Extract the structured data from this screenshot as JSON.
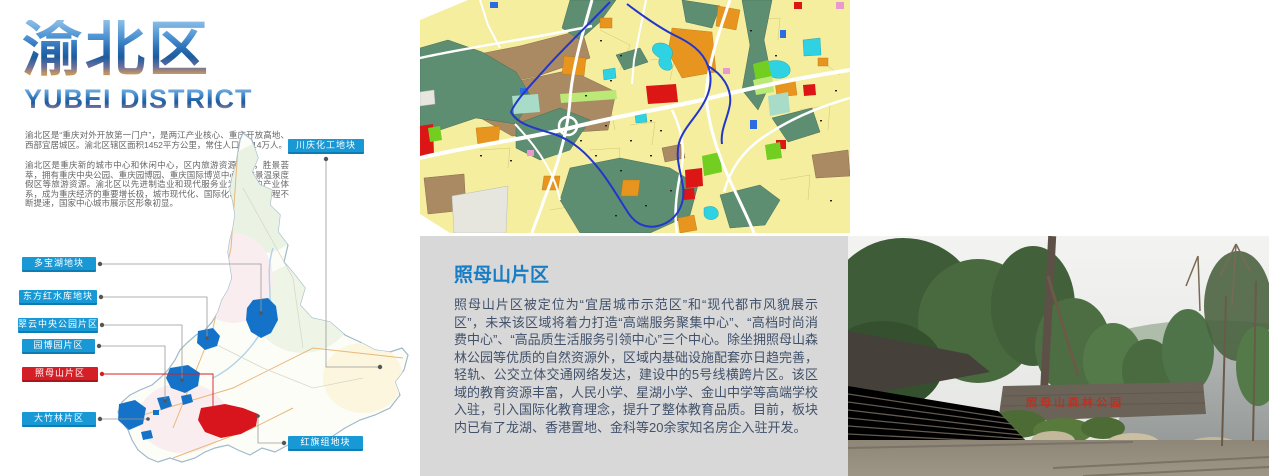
{
  "left": {
    "title_cn": "渝北区",
    "title_en": "YUBEI DISTRICT",
    "para1": "渝北区是“重庆对外开放第一门户”，是两江产业核心、重庆开放高地、西部宜居城区。渝北区辖区面积1452平方公里，常住人口约114万人。",
    "para2": "渝北区是重庆新的城市中心和休闲中心，区内旅游资源丰富，胜景荟萃，拥有重庆中央公园、重庆园博园、重庆国际博览中心、统景温泉度假区等旅游资源。渝北区以先进制造业和现代服务业为核心的产业体系，成为重庆经济的重要增长极，城市现代化、国际化、精细化进程不断提速，国家中心城市展示区形象初显。",
    "labels": [
      {
        "text": "川庆化工地块",
        "type": "blue"
      },
      {
        "text": "多宝湖地块",
        "type": "blue"
      },
      {
        "text": "东方红水库地块",
        "type": "blue"
      },
      {
        "text": "翠云中央公园片区",
        "type": "blue"
      },
      {
        "text": "园博园片区",
        "type": "blue"
      },
      {
        "text": "照母山片区",
        "type": "red"
      },
      {
        "text": "大竹林片区",
        "type": "blue"
      },
      {
        "text": "红旗组地块",
        "type": "blue"
      }
    ]
  },
  "panel": {
    "title": "照母山片区",
    "body": "照母山片区被定位为“宜居城市示范区”和“现代都市风貌展示区”，未来该区域将着力打造“高端服务聚集中心”、“高档时尚消费中心”、“高品质生活服务引领中心”三个中心。除坐拥照母山森林公园等优质的自然资源外，区域内基础设施配套亦日趋完善，轻轨、公交立体交通网络发达，建设中的5号线横跨片区。该区域的教育资源丰富，人民小学、星湖小学、金山中学等高端学校入驻，引入国际化教育理念，提升了整体教育品质。目前，板块内已有了龙湖、香港置地、金科等20余家知名房企入驻开发。"
  },
  "photo": {
    "wall_text": "照母山森林公园"
  },
  "colors": {
    "label_blue": "#1899d6",
    "label_blue_border": "#0d7cb2",
    "label_red": "#d41f26",
    "label_red_border": "#a8151b",
    "panel_bg": "#d8d8d8",
    "panel_title_blue": "#187dc5",
    "panel_text": "#41516b",
    "leader_gray": "#8a8a8a",
    "map_highlight_blue": "#1473c8",
    "map_highlight_red": "#d8151c"
  }
}
